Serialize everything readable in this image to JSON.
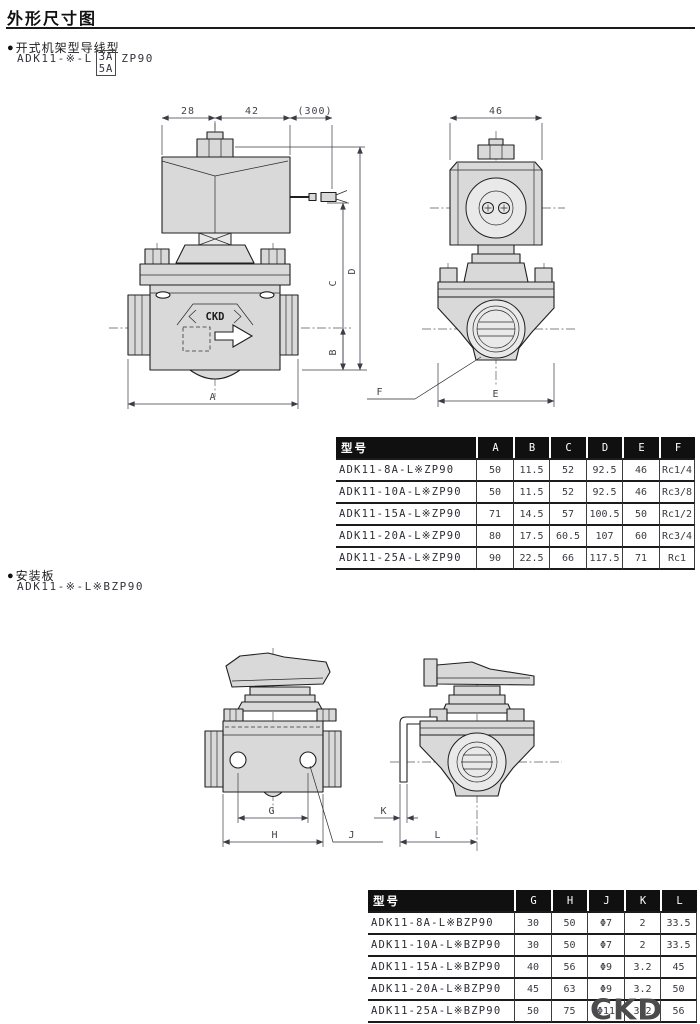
{
  "glyphs": {
    "bullet": "●"
  },
  "page": {
    "title": "外形尺寸图",
    "footer_logo": "CKD"
  },
  "section1": {
    "heading": "开式机架型导线型",
    "model_prefix": "ADK11-※-L",
    "variant_top": "3A",
    "variant_bottom": "5A",
    "model_suffix": "ZP90",
    "front_view": {
      "dim_28": "28",
      "dim_42": "42",
      "dim_300": "(300)",
      "label_A": "A",
      "label_B": "B",
      "label_C": "C",
      "label_D": "D",
      "body_logo": "CKD"
    },
    "side_view": {
      "dim_46": "46",
      "label_E": "E",
      "label_F": "F"
    },
    "table": {
      "headers": [
        "型号",
        "A",
        "B",
        "C",
        "D",
        "E",
        "F"
      ],
      "rows": [
        [
          "ADK11-8A-L※ZP90",
          "50",
          "11.5",
          "52",
          "92.5",
          "46",
          "Rc1/4"
        ],
        [
          "ADK11-10A-L※ZP90",
          "50",
          "11.5",
          "52",
          "92.5",
          "46",
          "Rc3/8"
        ],
        [
          "ADK11-15A-L※ZP90",
          "71",
          "14.5",
          "57",
          "100.5",
          "50",
          "Rc1/2"
        ],
        [
          "ADK11-20A-L※ZP90",
          "80",
          "17.5",
          "60.5",
          "107",
          "60",
          "Rc3/4"
        ],
        [
          "ADK11-25A-L※ZP90",
          "90",
          "22.5",
          "66",
          "117.5",
          "71",
          "Rc1"
        ]
      ]
    }
  },
  "section2": {
    "heading": "安装板",
    "model": "ADK11-※-L※BZP90",
    "front_view": {
      "label_G": "G",
      "label_H": "H",
      "label_J": "J"
    },
    "side_view": {
      "label_K": "K",
      "label_L": "L"
    },
    "table": {
      "headers": [
        "型号",
        "G",
        "H",
        "J",
        "K",
        "L"
      ],
      "rows": [
        [
          "ADK11-8A-L※BZP90",
          "30",
          "50",
          "Φ7",
          "2",
          "33.5"
        ],
        [
          "ADK11-10A-L※BZP90",
          "30",
          "50",
          "Φ7",
          "2",
          "33.5"
        ],
        [
          "ADK11-15A-L※BZP90",
          "40",
          "56",
          "Φ9",
          "3.2",
          "45"
        ],
        [
          "ADK11-20A-L※BZP90",
          "45",
          "63",
          "Φ9",
          "3.2",
          "50"
        ],
        [
          "ADK11-25A-L※BZP90",
          "50",
          "75",
          "Φ11",
          "3.2",
          "56"
        ]
      ]
    }
  }
}
